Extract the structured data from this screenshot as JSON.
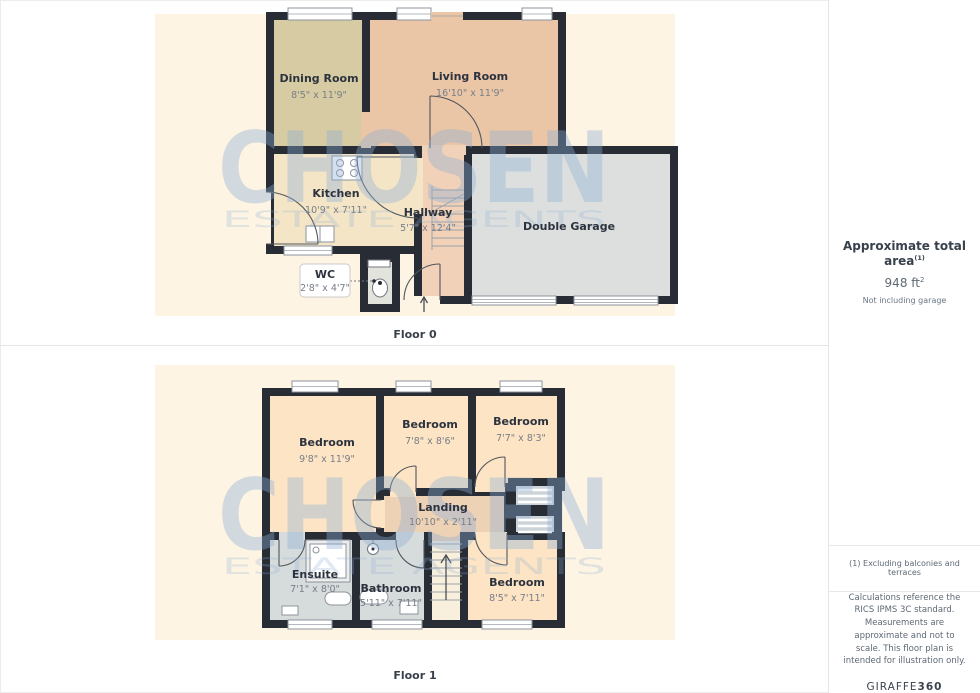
{
  "floors": [
    {
      "label": "Floor 0",
      "rooms": [
        {
          "name": "Dining Room",
          "dims": "8'5\" x 11'9\""
        },
        {
          "name": "Living Room",
          "dims": "16'10\" x 11'9\""
        },
        {
          "name": "Kitchen",
          "dims": "10'9\" x 7'11\""
        },
        {
          "name": "Hallway",
          "dims": "5'7\" x 12'4\""
        },
        {
          "name": "WC",
          "dims": "2'8\" x 4'7\""
        },
        {
          "name": "Double Garage",
          "dims": ""
        }
      ]
    },
    {
      "label": "Floor 1",
      "rooms": [
        {
          "name": "Bedroom",
          "dims": "9'8\" x 11'9\""
        },
        {
          "name": "Bedroom",
          "dims": "7'8\" x 8'6\""
        },
        {
          "name": "Bedroom",
          "dims": "7'7\" x 8'3\""
        },
        {
          "name": "Landing",
          "dims": "10'10\" x 2'11\""
        },
        {
          "name": "Ensuite",
          "dims": "7'1\" x 8'0\""
        },
        {
          "name": "Bathroom",
          "dims": "5'11\" x 7'11\""
        },
        {
          "name": "Bedroom",
          "dims": "8'5\" x 7'11\""
        }
      ]
    }
  ],
  "watermark": {
    "line1": "CHOSEN",
    "line2": "ESTATE AGENTS"
  },
  "sidebar": {
    "area_title": "Approximate total area",
    "area_sup": "(1)",
    "area_value": "948 ft",
    "area_value_sup": "2",
    "area_note": "Not including garage",
    "footnote": "(1) Excluding balconies and terraces",
    "disclaimer": "Calculations reference the RICS IPMS 3C standard. Measurements are approximate and not to scale. This floor plan is intended for illustration only.",
    "brand_name": "GIRAFFE",
    "brand_number": "360"
  },
  "colors": {
    "wall": "#272c35",
    "plan_background": "#fdf4e3",
    "dining_room": "#d7cba3",
    "living_room": "#eac6a6",
    "kitchen": "#f4e5c6",
    "hallway": "#f1d2b8",
    "garage": "#dcdfde",
    "bedroom": "#fce4c4",
    "landing": "#eed2b5",
    "bathroom": "#d6dbdc",
    "watermark": "#8fb0d6"
  }
}
